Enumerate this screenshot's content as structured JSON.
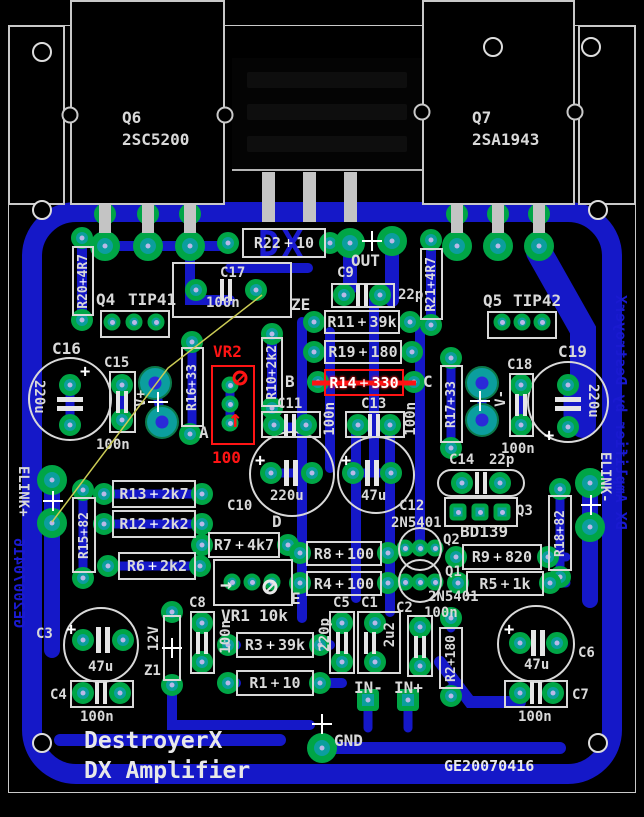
{
  "board": {
    "silk_title": "DestroyerX",
    "silk_subtitle": "DX Amplifier",
    "silk_datecode": "GE20070416",
    "copper": {
      "logo": "DX",
      "left_edge_text": "GE20070416",
      "right_edge_text": "DX Amplifier by DestroyerX"
    },
    "highlighted_components": [
      "VR2",
      "R14"
    ],
    "colors": {
      "substrate": "#000000",
      "copper_blue": "#1518c8",
      "pad_green": "#00a546",
      "pad_teal": "#0b9e9e",
      "silkscreen": "#d9d9d9",
      "highlight_red": "#ff1414",
      "ratsnest_yellow": "#cbcb55"
    }
  },
  "nets": {
    "out": "OUT",
    "ze": "ZE",
    "a": "A",
    "b": "B",
    "c": "C",
    "d": "D",
    "e": "E",
    "vplus": "V+",
    "vminus": "V-",
    "elink_plus": "ELINK+",
    "elink_minus": "ELINK-",
    "in_minus": "IN-",
    "in_plus": "IN+",
    "gnd": "GND"
  },
  "components": {
    "Q6": {
      "ref": "Q6",
      "value": "2SC5200"
    },
    "Q7": {
      "ref": "Q7",
      "value": "2SA1943"
    },
    "Q4": {
      "ref": "Q4",
      "value": "TIP41"
    },
    "Q5": {
      "ref": "Q5",
      "value": "TIP42"
    },
    "Q3": {
      "ref": "Q3",
      "value": "BD139"
    },
    "Q2": {
      "ref": "Q2",
      "value": "2N5401"
    },
    "Q1": {
      "ref": "Q1",
      "value": "2N5401"
    },
    "R1": {
      "ref": "R1",
      "value": "10"
    },
    "R2": {
      "ref": "R2",
      "value": "180"
    },
    "R3": {
      "ref": "R3",
      "value": "39k"
    },
    "R4": {
      "ref": "R4",
      "value": "100"
    },
    "R5": {
      "ref": "R5",
      "value": "1k"
    },
    "R6": {
      "ref": "R6",
      "value": "2k2"
    },
    "R7": {
      "ref": "R7",
      "value": "4k7"
    },
    "R8": {
      "ref": "R8",
      "value": "100"
    },
    "R9": {
      "ref": "R9",
      "value": "820"
    },
    "R10": {
      "ref": "R10",
      "value": "2k2"
    },
    "R11": {
      "ref": "R11",
      "value": "39k"
    },
    "R12": {
      "ref": "R12",
      "value": "2k2"
    },
    "R13": {
      "ref": "R13",
      "value": "2k7"
    },
    "R14": {
      "ref": "R14",
      "value": "330"
    },
    "R15": {
      "ref": "R15",
      "value": "82"
    },
    "R16": {
      "ref": "R16",
      "value": "33"
    },
    "R17": {
      "ref": "R17",
      "value": "33"
    },
    "R18": {
      "ref": "R18",
      "value": "82"
    },
    "R19": {
      "ref": "R19",
      "value": "180"
    },
    "R20": {
      "ref": "R20",
      "value": "4R7"
    },
    "R21": {
      "ref": "R21",
      "value": "4R7"
    },
    "R22": {
      "ref": "R22",
      "value": "10"
    },
    "C1": {
      "ref": "C1",
      "value": "2u2"
    },
    "C2": {
      "ref": "C2",
      "value": "100n"
    },
    "C3": {
      "ref": "C3",
      "value": "47u"
    },
    "C4": {
      "ref": "C4",
      "value": "100n"
    },
    "C5": {
      "ref": "C5",
      "value": "220p"
    },
    "C6": {
      "ref": "C6",
      "value": "47u"
    },
    "C7": {
      "ref": "C7",
      "value": "100n"
    },
    "C8": {
      "ref": "C8",
      "value": "100n"
    },
    "C9": {
      "ref": "C9",
      "value": "22p"
    },
    "C10": {
      "ref": "C10",
      "value": "220u"
    },
    "C11": {
      "ref": "C11",
      "value": "100n"
    },
    "C12": {
      "ref": "C12",
      "value": "47u"
    },
    "C13": {
      "ref": "C13",
      "value": "100n"
    },
    "C14": {
      "ref": "C14",
      "value": "22p"
    },
    "C15": {
      "ref": "C15",
      "value": "100n"
    },
    "C16": {
      "ref": "C16",
      "value": "220u"
    },
    "C17": {
      "ref": "C17",
      "value": "100n"
    },
    "C18": {
      "ref": "C18",
      "value": "100n"
    },
    "C19": {
      "ref": "C19",
      "value": "220u"
    },
    "VR1": {
      "ref": "VR1",
      "value": "10k"
    },
    "VR2": {
      "ref": "VR2",
      "value": "100"
    },
    "Z1": {
      "ref": "Z1",
      "value": "12V"
    }
  }
}
